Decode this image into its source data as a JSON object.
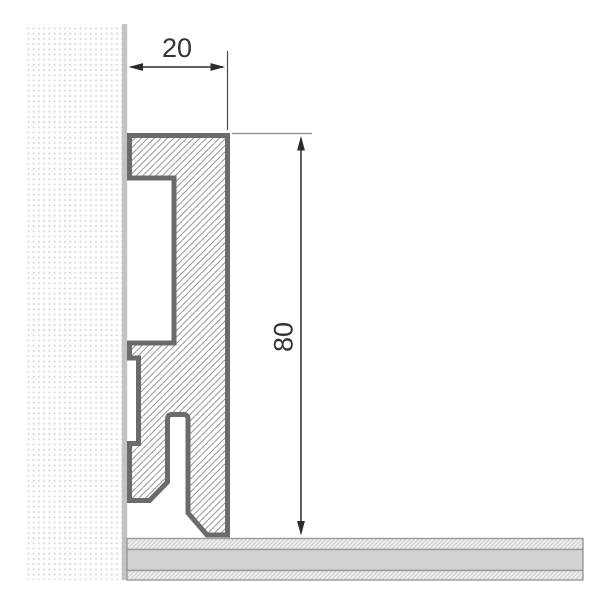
{
  "drawing": {
    "type": "skirting-profile-cross-section",
    "width_dimension": {
      "label": "20"
    },
    "height_dimension": {
      "label": "80"
    },
    "colors": {
      "dimension_ink": "#2b2b2b",
      "label_ink": "#333333",
      "extension_line_dark": "#4a4a4a",
      "extension_line_light": "#8a8a8a",
      "profile_border": "#6b6b6b",
      "profile_hatch": "#9c9c9c",
      "wall_dot": "#d5d5d5",
      "wall_edge_strip": "#c3c3c3",
      "floor_plain": "#d3d3d3",
      "floor_hatch_bg": "#ededed",
      "floor_hatch_line": "#c9c9c9",
      "floor_border": "#9a9a9a",
      "background": "#ffffff"
    }
  }
}
